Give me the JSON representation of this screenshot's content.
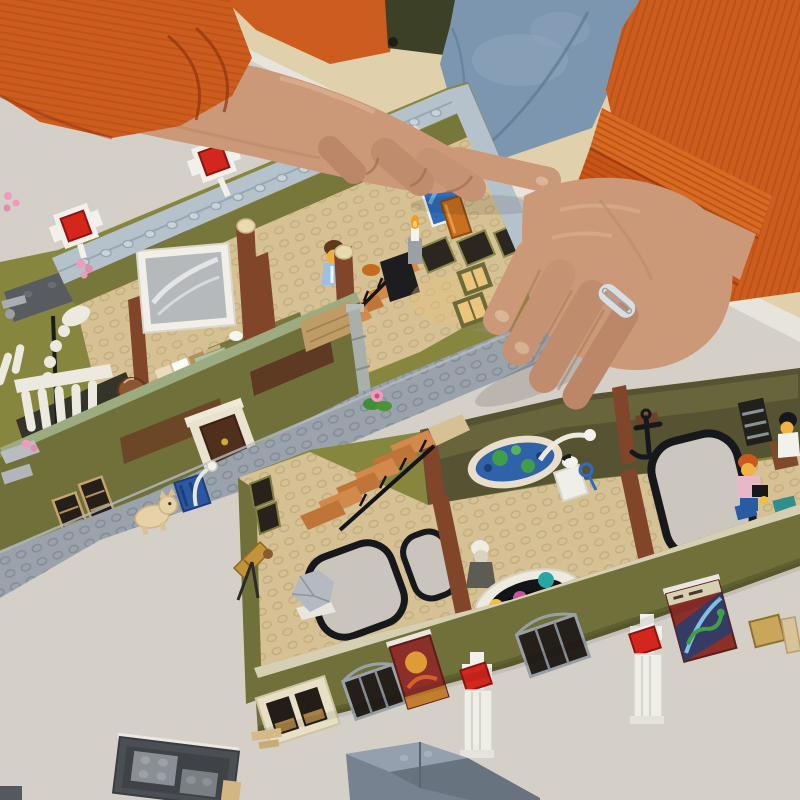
{
  "scene": {
    "type": "photograph",
    "description": "Overhead photo of a person assembling a large LEGO modular natural-history-museum model on a light grey table. Two olive-green floor sections lie open showing tan studded floors, a white dinosaur skeleton, terracotta staircases, a planet orrery exhibit, hanging poster banners and white columns topped with red tiles. The builder wears an orange corduroy jacket and a silver ring; loose grey wall modules sit at the bottom edge of the table.",
    "people": {
      "jacket": "orange corduroy jacket",
      "shirt": "dark olive shirt",
      "trousers": "blue denim jeans",
      "ring": "silver braided ring on right ring finger"
    },
    "objects": [
      "upper museum floor section with grey studded cornice",
      "white corner posts with red 2x2 tiles",
      "dinosaur skeleton exhibit",
      "framed grey whale picture",
      "terracotta staircase with black railing",
      "minifigure with brown hair",
      "blue painting and orange book",
      "olive street wall with door, windows and drainpipe",
      "grey studded sidewalk with cream bulldog and blue crate",
      "lower museum floor section with glossy back panels",
      "rowboat wall model and black anchor",
      "orrery with teal, magenta, yellow and ringed orange planets",
      "white statue figure and brass telescope",
      "grey rock specimen",
      "atrium openings with black railings",
      "two hanging dark-red poster banners",
      "child minifigure with orange hair and sailor minifigure",
      "loose dark grey wall module",
      "tan clip pieces",
      "blue-grey roof wedge",
      "pink flower pieces scattered on the table",
      "cardboard box at right edge"
    ]
  },
  "labels": {
    "table": "light grey table surface",
    "left_arm": "left arm in orange corduroy sleeve",
    "left_hand": "left hand resting on table edge",
    "right_arm": "right arm in orange corduroy sleeve with cuff",
    "right_hand": "right hand resting on model base, wearing silver ring",
    "upper_section": "upper museum floor section",
    "dino": "dinosaur skeleton exhibit",
    "picture": "framed grey picture",
    "upper_stairs": "upper section staircase with minifigure",
    "street_wall": "olive street wall with door and windows",
    "sidewalk": "grey studded sidewalk with bulldog",
    "lower_section": "lower museum floor section",
    "orrery": "planet orrery exhibit",
    "banners": "hanging poster banners",
    "pillars": "white columns with red tiles",
    "loose_pieces": "loose LEGO wall modules and wedge",
    "box": "cardboard box edge",
    "denim": "blue denim jeans",
    "tile": "white tile piece just placed"
  },
  "palette": {
    "table": "#d4d0c8",
    "table_edge": "#e7e4dc",
    "floor_bg": "#e0d0ab",
    "jacket": "#cd5d1e",
    "jacket_dark": "#a8440f",
    "cuff": "#d96a22",
    "denim": "#7d96b0",
    "shirt": "#3c4026",
    "skin": "#cb9878",
    "skin_shadow": "#a87a58",
    "ring_silver": "#d9dee3",
    "box_cardboard": "#c4a169",
    "olive_wall": "#86863f",
    "olive_wall_light": "#8f8f4b",
    "olive_dark": "#70703a",
    "glossy_panel": "#565332",
    "tan_floor": "#d5c193",
    "cornice": "#b6c2cb",
    "slate_band": "#585c60",
    "sidewalk": "#9aa2ab",
    "beam_brown": "#81452a",
    "stair_light": "#d28a4c",
    "stair_dark": "#c07538",
    "red_tile": "#d3271d",
    "lego_white": "#f1f0ea",
    "door_brown": "#50301c",
    "door_frame": "#e9e2cf",
    "dog_cream": "#e6d2a6",
    "crate_blue": "#2b58a2",
    "flower_pink": "#ef9cbc",
    "leaf_green": "#3f8f35",
    "skeleton_white": "#eceadf",
    "picture_gray": "#b5b9bb",
    "painting_blue": "#2e6cb8",
    "book_orange": "#c96f1e",
    "banner_red": "#8c2f28",
    "planet_teal": "#27a7a2",
    "planet_magenta": "#c8509c",
    "planet_yellow": "#f2c03a",
    "planet_orange": "#df7520",
    "telescope_gold": "#c1943c",
    "rock_gray": "#b4bac0",
    "wedge_gray": "#76828f",
    "module_dark": "#4b4f54",
    "window_dark": "#241f18",
    "window_lit": "#ecc57c",
    "sand_green": "#9cab80"
  }
}
